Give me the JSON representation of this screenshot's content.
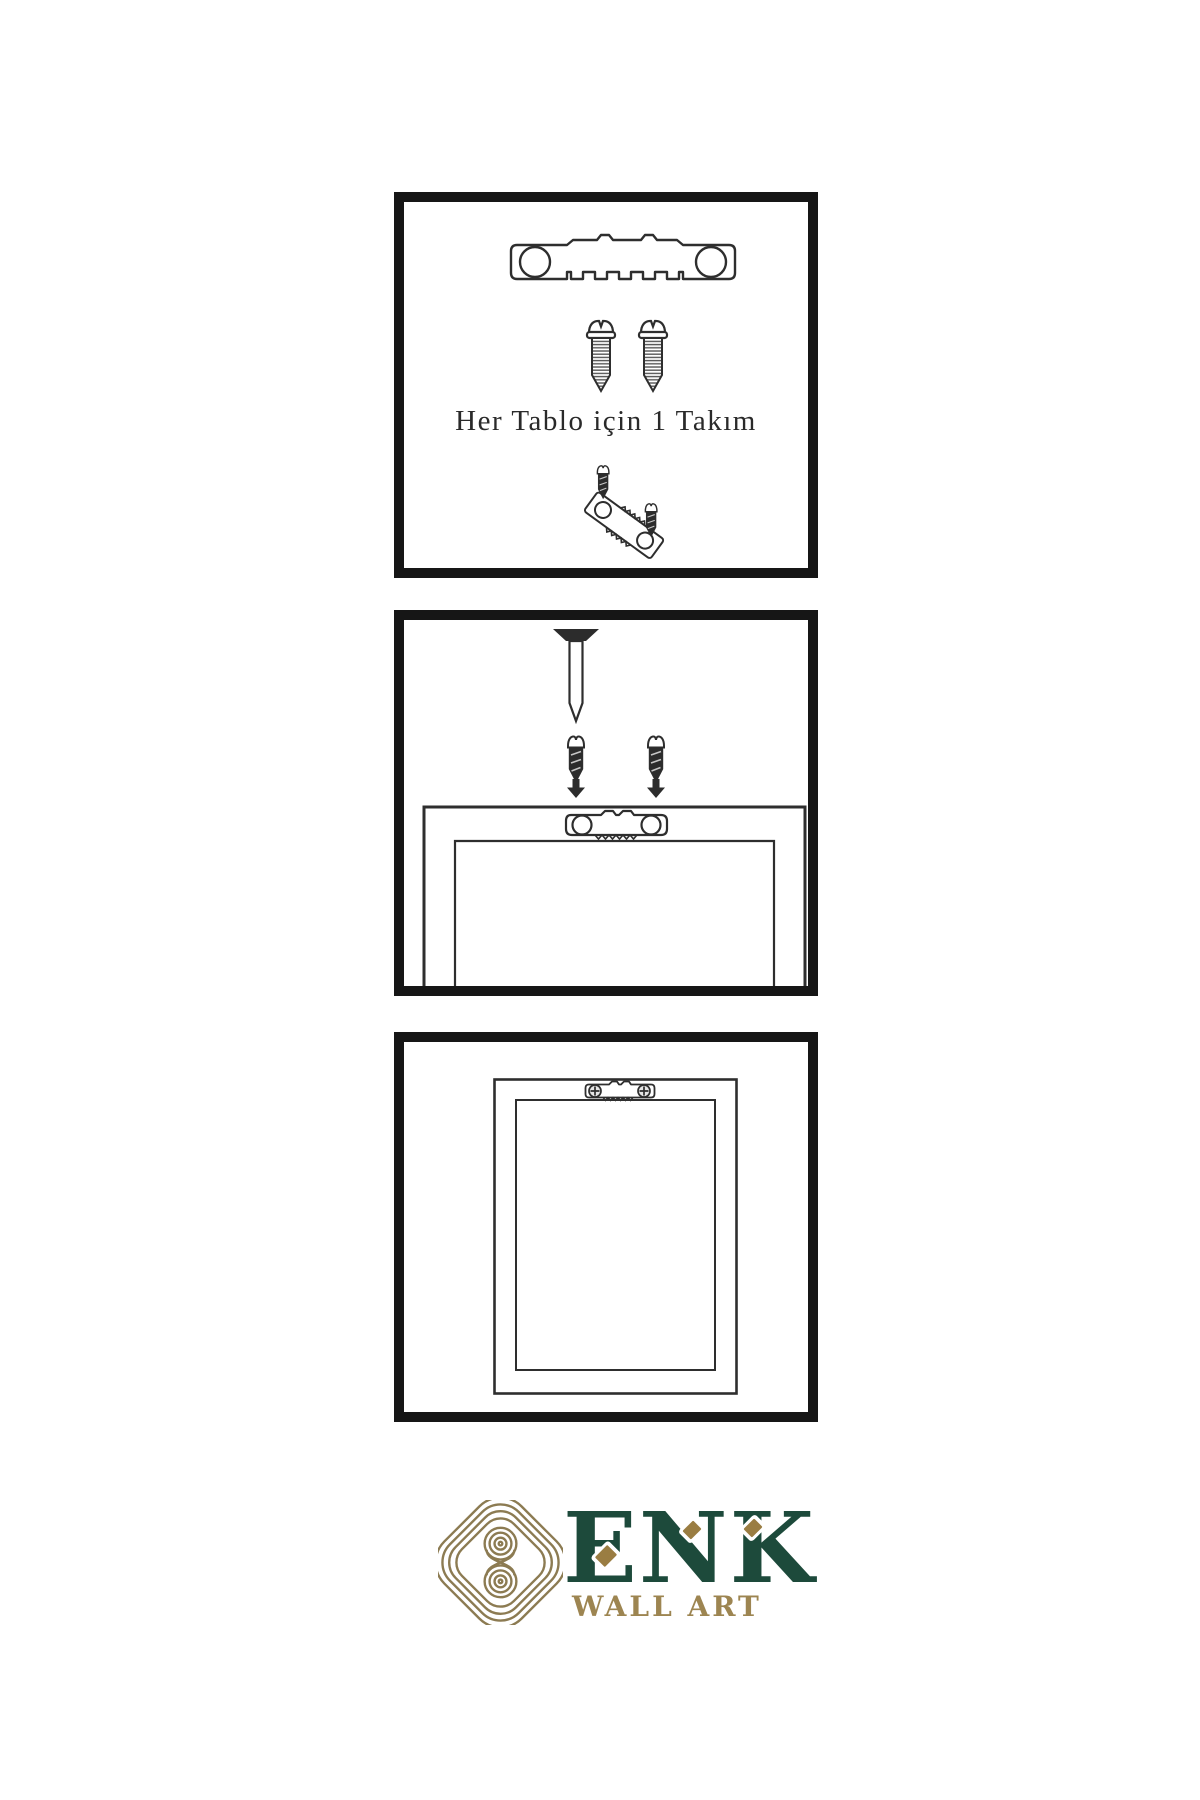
{
  "page": {
    "background": "#ffffff",
    "width": 1200,
    "height": 1800
  },
  "colors": {
    "page_bg": "#ffffff",
    "panel_border": "#161616",
    "ink": "#2e2e2e",
    "dark_fill": "#2c2c2c",
    "logo_green": "#1d4a3b",
    "logo_gold": "#9a7d42",
    "knot_gold": "#8c7b52",
    "wallart_gold": "#9d8551"
  },
  "panels": {
    "kit": {
      "caption": "Her Tablo için 1 Takım",
      "icons": [
        "sawtooth-hanger-icon",
        "screw-icon",
        "screw-icon",
        "hanger-assembly-icon"
      ]
    },
    "mount": {
      "icons": [
        "nail-icon",
        "dark-screw-icon",
        "dark-screw-icon",
        "arrow-down-icon",
        "arrow-down-icon",
        "frame-back-icon",
        "sawtooth-hanger-icon"
      ]
    },
    "hung": {
      "icons": [
        "picture-frame-icon",
        "sawtooth-hanger-icon",
        "phillips-screw-icon",
        "phillips-screw-icon"
      ]
    }
  },
  "brand": {
    "name": "ENK",
    "tagline": "WALL ART",
    "logo": "knot-logo-icon",
    "accents": [
      "diamond-accent",
      "diamond-accent",
      "diamond-accent"
    ]
  }
}
